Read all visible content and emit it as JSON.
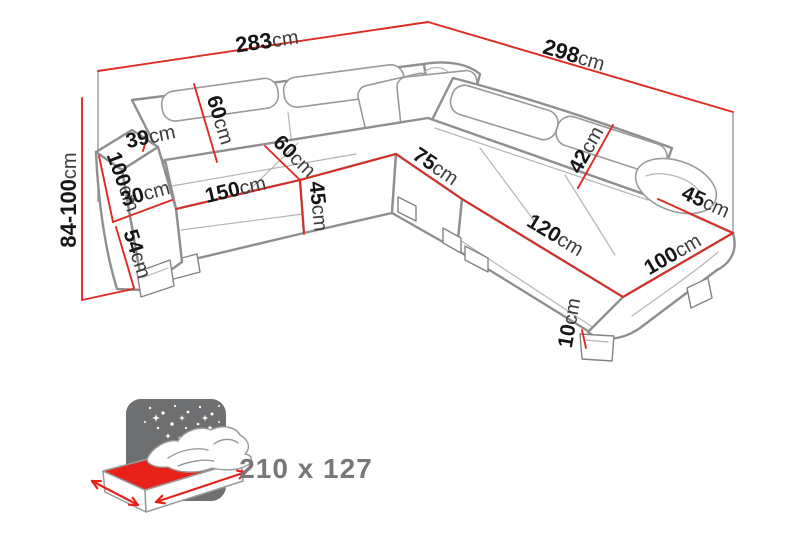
{
  "diagram": {
    "type": "corner-sofa-dimension-drawing",
    "measurements": [
      {
        "id": "total-width-top",
        "value": "283",
        "unit": "cm"
      },
      {
        "id": "total-depth-right",
        "value": "298",
        "unit": "cm"
      },
      {
        "id": "height-adjustable",
        "value": "84-100",
        "unit": "cm"
      },
      {
        "id": "backrest-height",
        "value": "60",
        "unit": "cm"
      },
      {
        "id": "armrest-top-width",
        "value": "39",
        "unit": "cm"
      },
      {
        "id": "armrest-depth",
        "value": "100",
        "unit": "cm"
      },
      {
        "id": "armrest-width",
        "value": "30",
        "unit": "cm"
      },
      {
        "id": "armrest-front-height",
        "value": "54",
        "unit": "cm"
      },
      {
        "id": "seat-width-left",
        "value": "150",
        "unit": "cm"
      },
      {
        "id": "seat-depth",
        "value": "60",
        "unit": "cm"
      },
      {
        "id": "seat-height",
        "value": "45",
        "unit": "cm"
      },
      {
        "id": "corner-seat-width",
        "value": "75",
        "unit": "cm"
      },
      {
        "id": "headrest-height",
        "value": "42",
        "unit": "cm"
      },
      {
        "id": "seat-width-right",
        "value": "120",
        "unit": "cm"
      },
      {
        "id": "right-armrest-width",
        "value": "45",
        "unit": "cm"
      },
      {
        "id": "chaise-length",
        "value": "100",
        "unit": "cm"
      },
      {
        "id": "leg-height",
        "value": "10",
        "unit": "cm"
      }
    ]
  },
  "sleeping_area": {
    "label": "210 x 127",
    "icon": "bed-night-sky-icon"
  },
  "colors": {
    "dimension_line": "#dd2b22",
    "mattress_red": "#e8211a",
    "icon_background": "#6e6f71",
    "sleeping_label": "#77787a",
    "sofa_outline": "#8f8f8f"
  }
}
